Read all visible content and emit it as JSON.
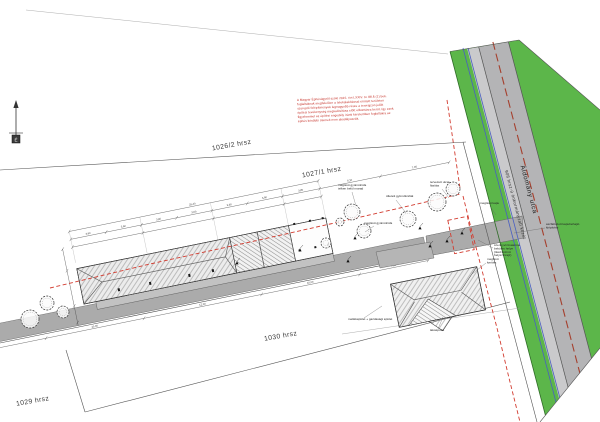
{
  "title": "Helyszínrajz - site plan",
  "colors": {
    "green": "#5cb64a",
    "road": "#b4b4b6",
    "sidewalk": "#cacacc",
    "driveway": "#ababab",
    "red_boundary": "#d23b2f",
    "blue_utility": "#4a5fc1",
    "brown_centerline": "#a5402e",
    "legal_text": "#c2261d"
  },
  "north": {
    "label": "É"
  },
  "parcels": {
    "p1": "1026/2 hrsz",
    "p2": "1027/1 hrsz",
    "p3": "1029 hrsz",
    "p4": "1030 hrsz"
  },
  "street": {
    "name": "Áldomány utca",
    "road_ref": "906 hrsz-ú önkormányzati közút"
  },
  "legal_note": {
    "lines": [
      "A Magyar Építésügyről szóló 2016. évi LXXIV. tv. 88.§ (1) bek.",
      "foglaltaknak megfelelően a telekalakítással érintett területen",
      "szereplő felépítmények legnagyobb része a tervrajzon jelölt",
      "építési tevékenység megvalósítása előtt elbontásra kerül, így ezek",
      "figyelemmel az építési engedély iránti kérelemben foglaltakra az",
      "építés későbbi ütemeit nem akadályozzák."
    ]
  },
  "annotations": [
    {
      "x": 338,
      "y": 186,
      "lines": [
        "meglévő gyümölcsfa",
        "telken belül marad"
      ],
      "leader": [
        352,
        192,
        356,
        206
      ]
    },
    {
      "x": 386,
      "y": 197,
      "lines": [
        "ültetett gyümölcsfák"
      ],
      "leader": [
        396,
        200,
        406,
        213
      ]
    },
    {
      "x": 430,
      "y": 183,
      "lines": [
        "tervezett utcai",
        "fásítás"
      ],
      "leader": [
        442,
        189,
        449,
        198
      ]
    },
    {
      "x": 364,
      "y": 224,
      "lines": [
        "meglévő gyümölcsfa"
      ],
      "leader": [
        374,
        226,
        365,
        232
      ]
    },
    {
      "x": 546,
      "y": 225,
      "lines": [
        "aszfaltozott kapubehajtó",
        "kiépítése"
      ],
      "leader": [
        545,
        228,
        514,
        233
      ]
    },
    {
      "x": 494,
      "y": 246,
      "lines": [
        "szennyvízcsatorna",
        "bekötés helye",
        "(lásd közmű",
        "helyszínrajz)"
      ],
      "leader": [
        493,
        248,
        478,
        240
      ]
    },
    {
      "x": 487,
      "y": 260,
      "lines": [
        "meglévő",
        "kerítés"
      ],
      "leader": [
        486,
        263,
        472,
        274
      ]
    },
    {
      "x": 348,
      "y": 320,
      "lines": [
        "melléképület + gazdasági épület"
      ],
      "leader": [
        364,
        318,
        382,
        306
      ]
    },
    {
      "x": 430,
      "y": 331,
      "lines": [
        "lakóépület"
      ],
      "leader": [
        438,
        329,
        443,
        317
      ]
    },
    {
      "x": 480,
      "y": 204,
      "lines": [
        "meglévő kapu"
      ],
      "leader": [
        490,
        206,
        496,
        215
      ]
    }
  ],
  "trees": [
    {
      "x": 352,
      "y": 212,
      "r": 8
    },
    {
      "x": 364,
      "y": 231,
      "r": 7
    },
    {
      "x": 326,
      "y": 243,
      "r": 5
    },
    {
      "x": 340,
      "y": 222,
      "r": 4
    },
    {
      "x": 408,
      "y": 219,
      "r": 8
    },
    {
      "x": 437,
      "y": 202,
      "r": 9
    },
    {
      "x": 453,
      "y": 189,
      "r": 7
    },
    {
      "x": 30,
      "y": 319,
      "r": 9
    },
    {
      "x": 47,
      "y": 303,
      "r": 7
    },
    {
      "x": 63,
      "y": 312,
      "r": 6
    }
  ],
  "markers": [
    [
      237,
      263
    ],
    [
      300,
      250
    ],
    [
      355,
      238
    ],
    [
      420,
      228
    ],
    [
      447,
      241
    ],
    [
      462,
      233
    ],
    [
      348,
      261
    ],
    [
      430,
      246
    ]
  ],
  "dimensions": {
    "main": [
      {
        "t": "3,60",
        "x": 102,
        "y": 236.6
      },
      {
        "t": "3,60",
        "x": 138,
        "y": 236.6
      },
      {
        "t": "3,60",
        "x": 174,
        "y": 236.6
      },
      {
        "t": "3,60",
        "x": 210,
        "y": 236.6
      },
      {
        "t": "3,60",
        "x": 246,
        "y": 236.6
      },
      {
        "t": "3,60",
        "x": 282,
        "y": 236.6
      },
      {
        "t": "3,80",
        "x": 319,
        "y": 236.6
      },
      {
        "t": "25,40",
        "x": 210,
        "y": 228.6
      },
      {
        "t": "6,10",
        "x": 369,
        "y": 236.6
      },
      {
        "t": "7,05",
        "x": 435,
        "y": 236.6
      },
      {
        "t": "9,95",
        "x": -10,
        "y": 328.8
      },
      {
        "t": "10,00",
        "x": 90,
        "y": 328.8
      },
      {
        "t": "12,00",
        "x": 200,
        "y": 328.8
      },
      {
        "t": "10,00",
        "x": 310,
        "y": 328.8
      },
      {
        "t": "7,00",
        "x": 395,
        "y": 328.8
      }
    ]
  }
}
